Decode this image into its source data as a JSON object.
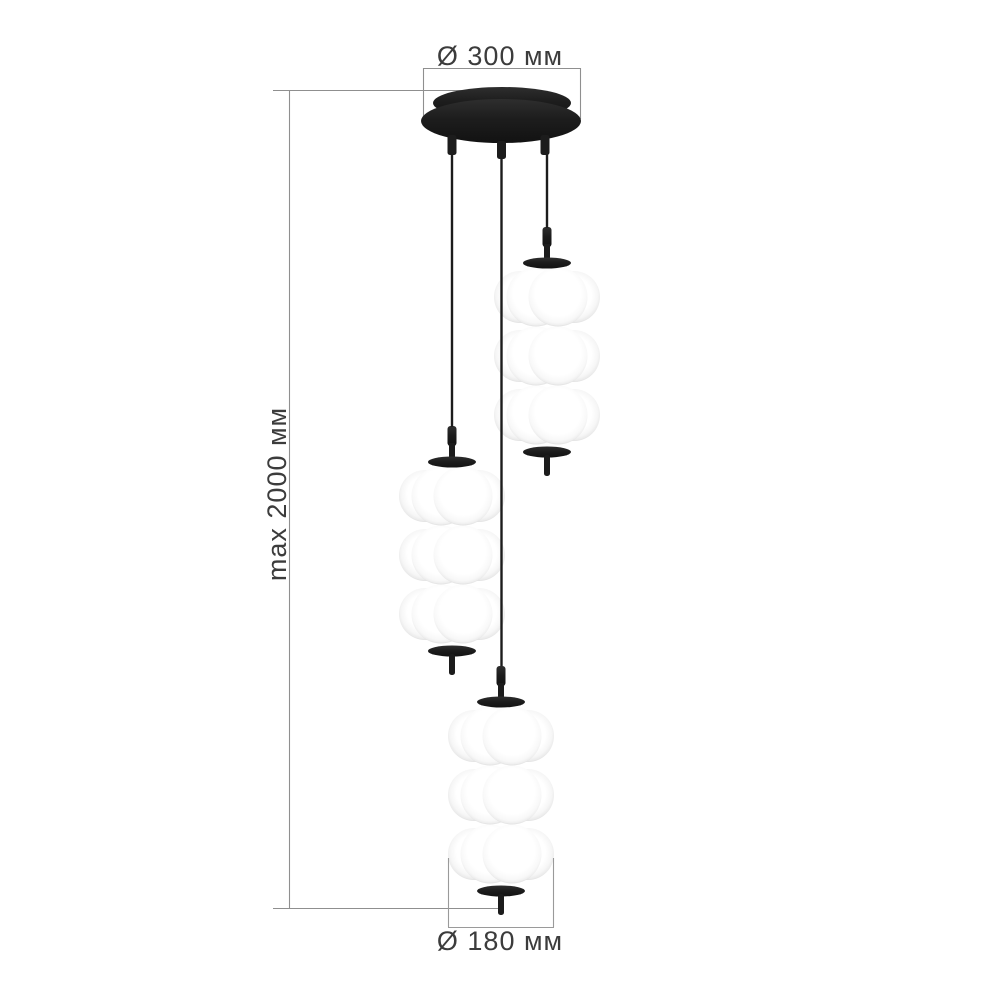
{
  "drawing": {
    "labels": {
      "canopy_diameter": "Ø 300 мм",
      "max_height": "max 2000 мм",
      "shade_diameter": "Ø 180 мм"
    },
    "colors": {
      "background": "#ffffff",
      "fixture_black": "#1c1c1c",
      "dimension_line_gray": "#8f8f8f",
      "label_text_gray": "#3c3c3c",
      "diffuser_white": "#ffffff",
      "diffuser_edge_shade": "#e3e3e3"
    }
  }
}
